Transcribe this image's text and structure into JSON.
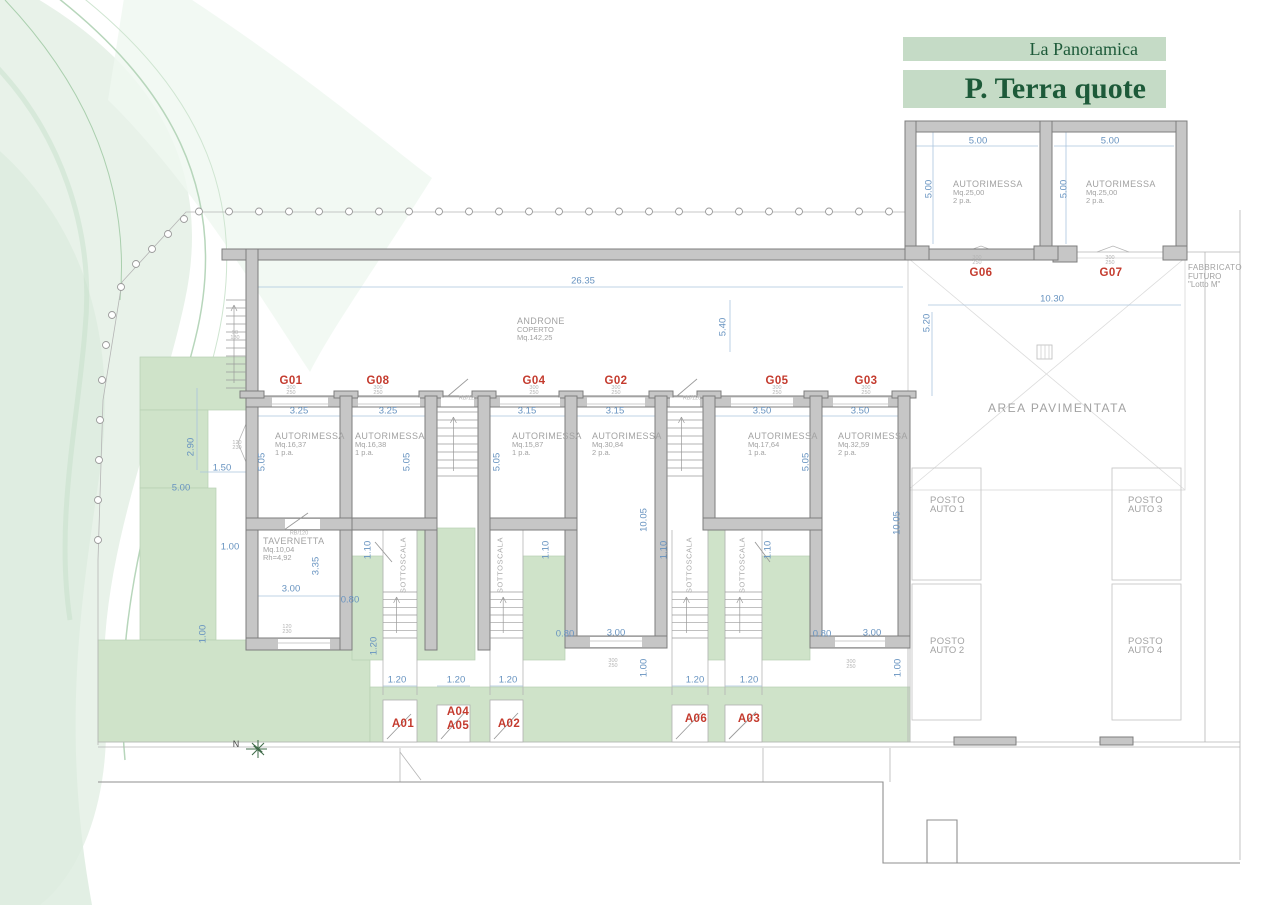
{
  "header": {
    "project_name": "La Panoramica",
    "sheet_title": "P. Terra quote"
  },
  "north": {
    "label": "N"
  },
  "colors": {
    "band_green": "#c5dbc6",
    "heading_green": "#1d5a39",
    "dimension_blue": "#6793c0",
    "unit_label_red": "#c43b2e",
    "lawn_green": "#cfe3c9",
    "wall_gray": "#c6c6c6"
  },
  "annotations": {
    "rooms": [
      {
        "lines": [
          "AUTORIMESSA",
          "Mq.16,37",
          "1 p.a."
        ],
        "x": 275,
        "y": 431
      },
      {
        "lines": [
          "AUTORIMESSA",
          "Mq.16,38",
          "1 p.a."
        ],
        "x": 355,
        "y": 431
      },
      {
        "lines": [
          "AUTORIMESSA",
          "Mq.15,87",
          "1 p.a."
        ],
        "x": 512,
        "y": 431
      },
      {
        "lines": [
          "AUTORIMESSA",
          "Mq.30,84",
          "2 p.a."
        ],
        "x": 592,
        "y": 431
      },
      {
        "lines": [
          "AUTORIMESSA",
          "Mq.17,64",
          "1 p.a."
        ],
        "x": 748,
        "y": 431
      },
      {
        "lines": [
          "AUTORIMESSA",
          "Mq.32,59",
          "2 p.a."
        ],
        "x": 838,
        "y": 431
      },
      {
        "lines": [
          "AUTORIMESSA",
          "Mq.25,00",
          "2 p.a."
        ],
        "x": 953,
        "y": 179
      },
      {
        "lines": [
          "AUTORIMESSA",
          "Mq.25,00",
          "2 p.a."
        ],
        "x": 1086,
        "y": 179
      },
      {
        "lines": [
          "TAVERNETTA",
          "Mq.10,04",
          "Rh=4,92"
        ],
        "x": 263,
        "y": 536
      },
      {
        "lines": [
          "ANDRONE",
          "COPERTO",
          "Mq.142,25"
        ],
        "x": 517,
        "y": 316
      },
      {
        "lines": [
          "FABBRICATO",
          "FUTURO",
          "\"Lotto M\""
        ],
        "x": 1188,
        "y": 263,
        "fs": 8,
        "fss": 8
      },
      {
        "lines": [
          "POSTO",
          "AUTO 1"
        ],
        "x": 930,
        "y": 496,
        "fs": 9.5,
        "fss": 9.5
      },
      {
        "lines": [
          "POSTO",
          "AUTO 2"
        ],
        "x": 930,
        "y": 637,
        "fs": 9.5,
        "fss": 9.5
      },
      {
        "lines": [
          "POSTO",
          "AUTO 3"
        ],
        "x": 1128,
        "y": 496,
        "fs": 9.5,
        "fss": 9.5
      },
      {
        "lines": [
          "POSTO",
          "AUTO 4"
        ],
        "x": 1128,
        "y": 637,
        "fs": 9.5,
        "fss": 9.5
      },
      {
        "lines": [
          "AREA PAVIMENTATA"
        ],
        "x": 988,
        "y": 403,
        "fs": 12,
        "sp": 1.5
      }
    ],
    "unit_labels": [
      {
        "t": "G01",
        "x": 291,
        "y": 381
      },
      {
        "t": "G08",
        "x": 378,
        "y": 381
      },
      {
        "t": "G04",
        "x": 534,
        "y": 381
      },
      {
        "t": "G02",
        "x": 616,
        "y": 381
      },
      {
        "t": "G05",
        "x": 777,
        "y": 381
      },
      {
        "t": "G03",
        "x": 866,
        "y": 381
      },
      {
        "t": "G06",
        "x": 981,
        "y": 273
      },
      {
        "t": "G07",
        "x": 1111,
        "y": 273
      },
      {
        "t": "A01",
        "x": 403,
        "y": 724
      },
      {
        "t": "A04",
        "x": 458,
        "y": 712
      },
      {
        "t": "A05",
        "x": 458,
        "y": 726
      },
      {
        "t": "A02",
        "x": 509,
        "y": 724
      },
      {
        "t": "A06",
        "x": 696,
        "y": 719
      },
      {
        "t": "A03",
        "x": 749,
        "y": 719
      }
    ],
    "dimensions": [
      {
        "t": "26.35",
        "x": 583,
        "y": 281
      },
      {
        "t": "5.40",
        "x": 723,
        "y": 327,
        "v": 1
      },
      {
        "t": "3.25",
        "x": 299,
        "y": 411
      },
      {
        "t": "3.25",
        "x": 388,
        "y": 411
      },
      {
        "t": "3.15",
        "x": 527,
        "y": 411
      },
      {
        "t": "3.15",
        "x": 615,
        "y": 411
      },
      {
        "t": "3.50",
        "x": 762,
        "y": 411
      },
      {
        "t": "3.50",
        "x": 860,
        "y": 411
      },
      {
        "t": "5.05",
        "x": 262,
        "y": 462,
        "v": 1
      },
      {
        "t": "5.05",
        "x": 407,
        "y": 462,
        "v": 1
      },
      {
        "t": "5.05",
        "x": 497,
        "y": 462,
        "v": 1
      },
      {
        "t": "5.05",
        "x": 806,
        "y": 462,
        "v": 1
      },
      {
        "t": "10.05",
        "x": 644,
        "y": 520,
        "v": 1
      },
      {
        "t": "10.05",
        "x": 897,
        "y": 523,
        "v": 1
      },
      {
        "t": "5.00",
        "x": 978,
        "y": 141
      },
      {
        "t": "5.00",
        "x": 1110,
        "y": 141
      },
      {
        "t": "5.00",
        "x": 929,
        "y": 189,
        "v": 1
      },
      {
        "t": "5.00",
        "x": 1064,
        "y": 189,
        "v": 1
      },
      {
        "t": "10.30",
        "x": 1052,
        "y": 299
      },
      {
        "t": "5.20",
        "x": 927,
        "y": 323,
        "v": 1
      },
      {
        "t": "2.90",
        "x": 191,
        "y": 447,
        "v": 1
      },
      {
        "t": "1.50",
        "x": 222,
        "y": 468
      },
      {
        "t": "5.00",
        "x": 181,
        "y": 488
      },
      {
        "t": "1.00",
        "x": 230,
        "y": 547
      },
      {
        "t": "3.00",
        "x": 291,
        "y": 589
      },
      {
        "t": "3.35",
        "x": 316,
        "y": 566,
        "v": 1
      },
      {
        "t": "1.00",
        "x": 203,
        "y": 634,
        "v": 1
      },
      {
        "t": "0.80",
        "x": 350,
        "y": 600
      },
      {
        "t": "1.10",
        "x": 368,
        "y": 550,
        "v": 1
      },
      {
        "t": "1.10",
        "x": 546,
        "y": 550,
        "v": 1
      },
      {
        "t": "1.10",
        "x": 664,
        "y": 550,
        "v": 1
      },
      {
        "t": "1.10",
        "x": 768,
        "y": 550,
        "v": 1
      },
      {
        "t": "1.20",
        "x": 374,
        "y": 646,
        "v": 1
      },
      {
        "t": "1.20",
        "x": 397,
        "y": 680
      },
      {
        "t": "1.20",
        "x": 456,
        "y": 680
      },
      {
        "t": "1.20",
        "x": 508,
        "y": 680
      },
      {
        "t": "1.20",
        "x": 695,
        "y": 680
      },
      {
        "t": "1.20",
        "x": 749,
        "y": 680
      },
      {
        "t": "0.80",
        "x": 565,
        "y": 634
      },
      {
        "t": "3.00",
        "x": 616,
        "y": 633
      },
      {
        "t": "1.00",
        "x": 644,
        "y": 668,
        "v": 1
      },
      {
        "t": "0.80",
        "x": 822,
        "y": 634
      },
      {
        "t": "3.00",
        "x": 872,
        "y": 633
      },
      {
        "t": "1.00",
        "x": 898,
        "y": 668,
        "v": 1
      }
    ],
    "small_labels": [
      {
        "t": "300\n250",
        "x": 291,
        "y": 391
      },
      {
        "t": "300\n250",
        "x": 378,
        "y": 391
      },
      {
        "t": "300\n250",
        "x": 534,
        "y": 391
      },
      {
        "t": "300\n250",
        "x": 616,
        "y": 391
      },
      {
        "t": "300\n250",
        "x": 777,
        "y": 391
      },
      {
        "t": "300\n250",
        "x": 866,
        "y": 391
      },
      {
        "t": "300\n250",
        "x": 977,
        "y": 261
      },
      {
        "t": "300\n250",
        "x": 1110,
        "y": 261
      },
      {
        "t": "300\n250",
        "x": 613,
        "y": 664
      },
      {
        "t": "300\n250",
        "x": 851,
        "y": 665
      },
      {
        "t": "120\n230",
        "x": 237,
        "y": 446
      },
      {
        "t": "120\n230",
        "x": 287,
        "y": 630
      },
      {
        "t": "90\n130",
        "x": 235,
        "y": 336
      },
      {
        "t": "RB/120",
        "x": 468,
        "y": 399
      },
      {
        "t": "RB/120",
        "x": 692,
        "y": 399
      },
      {
        "t": "RB/120",
        "x": 299,
        "y": 534
      }
    ],
    "stair_labels": [
      {
        "t": "SOTTOSCALA",
        "x": 403,
        "y": 565
      },
      {
        "t": "SOTTOSCALA",
        "x": 500,
        "y": 565
      },
      {
        "t": "SOTTOSCALA",
        "x": 689,
        "y": 565
      },
      {
        "t": "SOTTOSCALA",
        "x": 742,
        "y": 565
      }
    ]
  }
}
